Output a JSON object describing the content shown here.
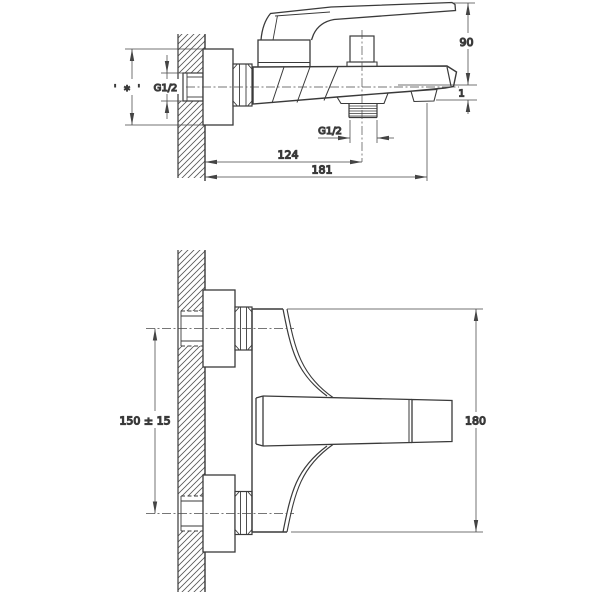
{
  "drawing": {
    "background": "#ffffff",
    "line_color": "#3a3a3a",
    "dim_color": "#444444",
    "views": {
      "side": {
        "name": "side-projection-view",
        "labels": {
          "height": "90",
          "lip": "1",
          "inlet_thread": "G1/2",
          "outlet_thread": "G1/2",
          "depth_to_diverter": "124",
          "depth_total": "181",
          "inlet_marks": "' ∗ '"
        }
      },
      "front": {
        "name": "front-view",
        "labels": {
          "hole_spacing": "150 ± 15",
          "overall_height": "180"
        }
      }
    }
  }
}
